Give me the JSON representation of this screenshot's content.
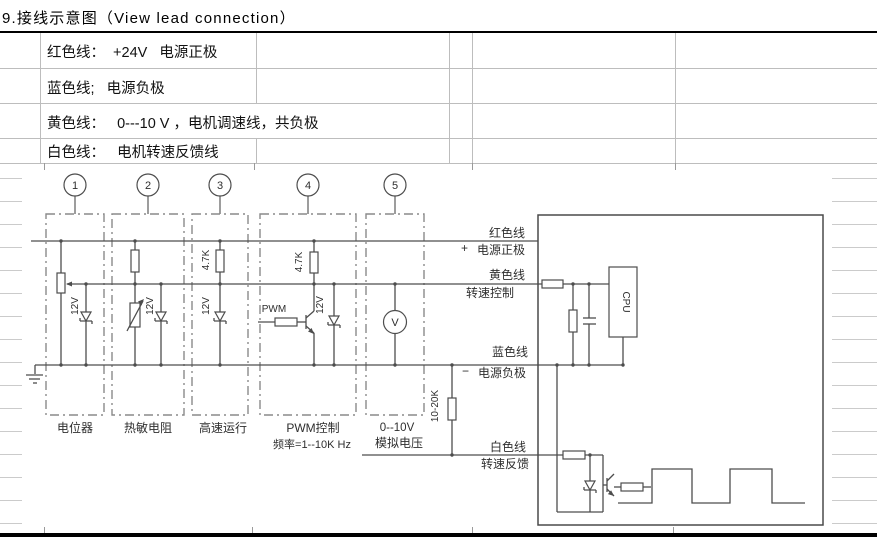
{
  "title": "9.接线示意图（View lead connection）",
  "legend": {
    "rows": [
      {
        "label": "红色线：  +24V   电源正极"
      },
      {
        "label": "蓝色线;   电源负极"
      },
      {
        "label": "黄色线：   0---10 V ，电机调速线，共负极"
      },
      {
        "label": "白色线：   电机转速反馈线"
      }
    ]
  },
  "diagram": {
    "terminals": [
      "1",
      "2",
      "3",
      "4",
      "5"
    ],
    "captions": {
      "box1": "电位器",
      "box2": "热敏电阻",
      "box3": "高速运行",
      "box4": "PWM控制",
      "box4_freq": "频率=1--10K Hz",
      "box5": "0--10V",
      "box5_sub": "模拟电压"
    },
    "components": {
      "zener": "12V",
      "r47k": "4.7K",
      "pull": "10-20K",
      "pwm": "PWM",
      "cpu": "CPU",
      "voltmeter": "V"
    },
    "wires": {
      "red_name": "红色线",
      "red_sign": "+",
      "red_desc": "电源正极",
      "yellow_name": "黄色线",
      "yellow_desc": "转速控制",
      "blue_name": "蓝色线",
      "blue_sign": "−",
      "blue_desc": "电源负极",
      "white_name": "白色线",
      "white_desc": "转速反馈"
    }
  }
}
